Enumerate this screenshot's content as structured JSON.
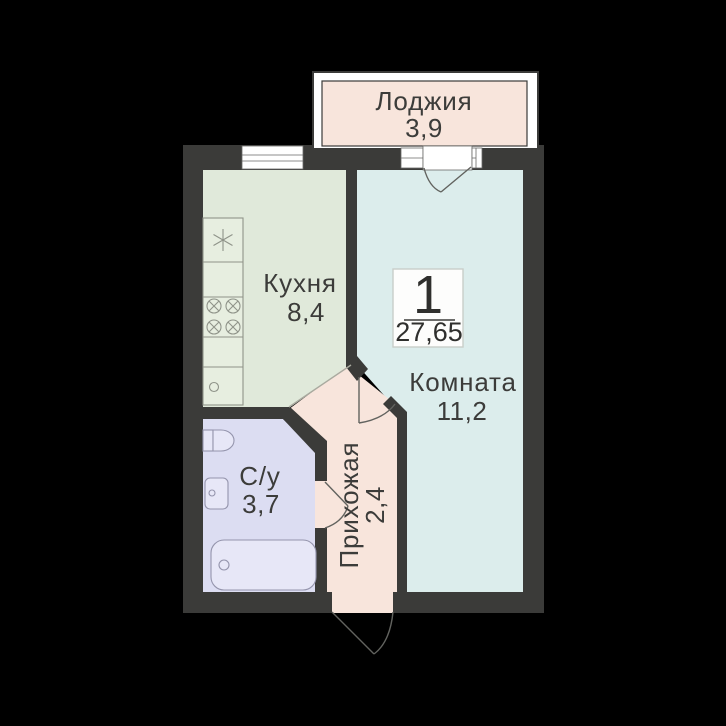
{
  "plan": {
    "badge": {
      "flat_number": "1",
      "total_area": "27,65"
    },
    "rooms": [
      {
        "name": "Лоджия",
        "area": "3,9"
      },
      {
        "name": "Кухня",
        "area": "8,4"
      },
      {
        "name": "Комната",
        "area": "11,2"
      },
      {
        "name": "С/у",
        "area": "3,7"
      },
      {
        "name": "Прихожая",
        "area": "2,4"
      }
    ],
    "colors": {
      "background": "#000000",
      "walls": "#3b3b39",
      "kitchen_floor": "#e0e9da",
      "room_floor": "#dcedec",
      "bathroom_floor": "#dcddf2",
      "hallway_floor": "#f8e5dc",
      "loggia_floor": "#f8e5dc",
      "window": "#ffffff",
      "door_line": "#62635f",
      "text": "#3c3c3a",
      "badge_border": "#c9cec9"
    }
  }
}
